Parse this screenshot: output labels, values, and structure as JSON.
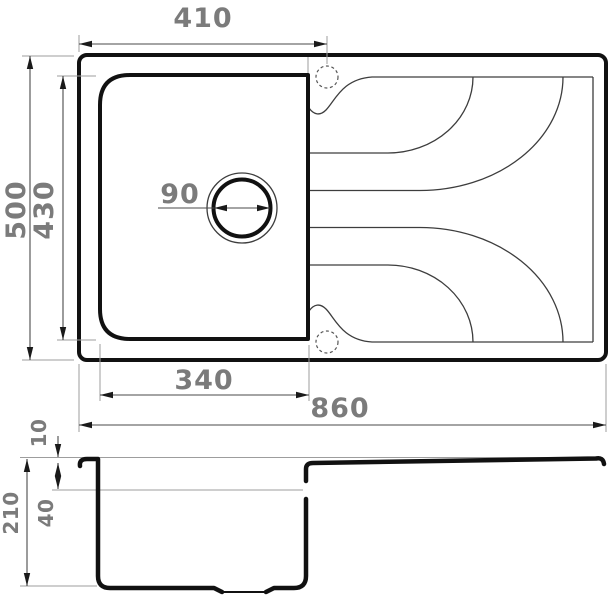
{
  "drawing": {
    "subject": "kitchen-sink-dimension-drawing",
    "views": {
      "top": "plan view with bowl, drain and drainboard grooves",
      "side": "section profile view"
    },
    "dimensions": {
      "top": {
        "tap_hole_offset": "410",
        "overall_depth": "500",
        "bowl_inner_depth": "430",
        "drain_diameter": "90",
        "bowl_inner_width": "340",
        "overall_length": "860"
      },
      "side": {
        "rim_height": "10",
        "overall_height": "210",
        "upper_depth": "40"
      }
    },
    "colors": {
      "outline": "#111111",
      "thin_line": "#3d3d3d",
      "dimension_line": "#4a4a4a",
      "extension_line": "#9d9d9d",
      "label_text": "#7b7b7b",
      "background": "#ffffff"
    }
  }
}
